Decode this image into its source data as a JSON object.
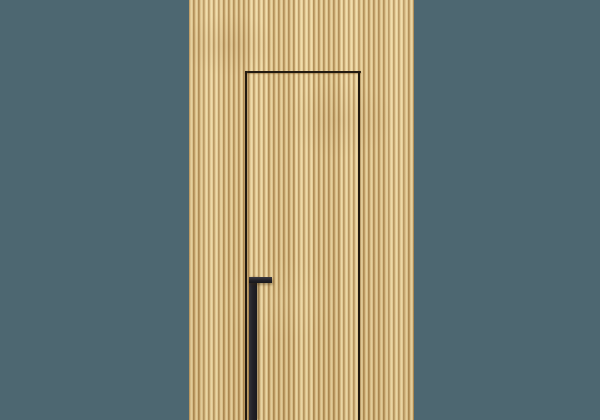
{
  "scene": {
    "description": "Photorealistic render of a concealed flush door integrated into a vertical fluted oak wood slat wall panel, set against a plain slate-teal wall; the hidden door is outlined by thin dark seam lines and has a matte black L-shaped pull handle reaching the bottom edge of the frame.",
    "wall": {
      "name": "wall-background"
    },
    "panel": {
      "name": "fluted-wood-panel",
      "material": "light oak vertical slats",
      "slat_period_px": 5
    },
    "door": {
      "name": "hidden-door",
      "seam_edges": [
        "top",
        "left",
        "right"
      ],
      "bottom_edge": "cropped at image bottom"
    },
    "handle": {
      "name": "door-pull-handle",
      "shape": "inverted-L vertical pull with short horizontal top grip"
    }
  },
  "colors": {
    "wall": "#4d6771",
    "wood-base": "#dfc28a",
    "wood-ridge": "#eed9a4",
    "wood-groove": "#a07d46",
    "seam": "#221a10",
    "handle": "#232228"
  }
}
